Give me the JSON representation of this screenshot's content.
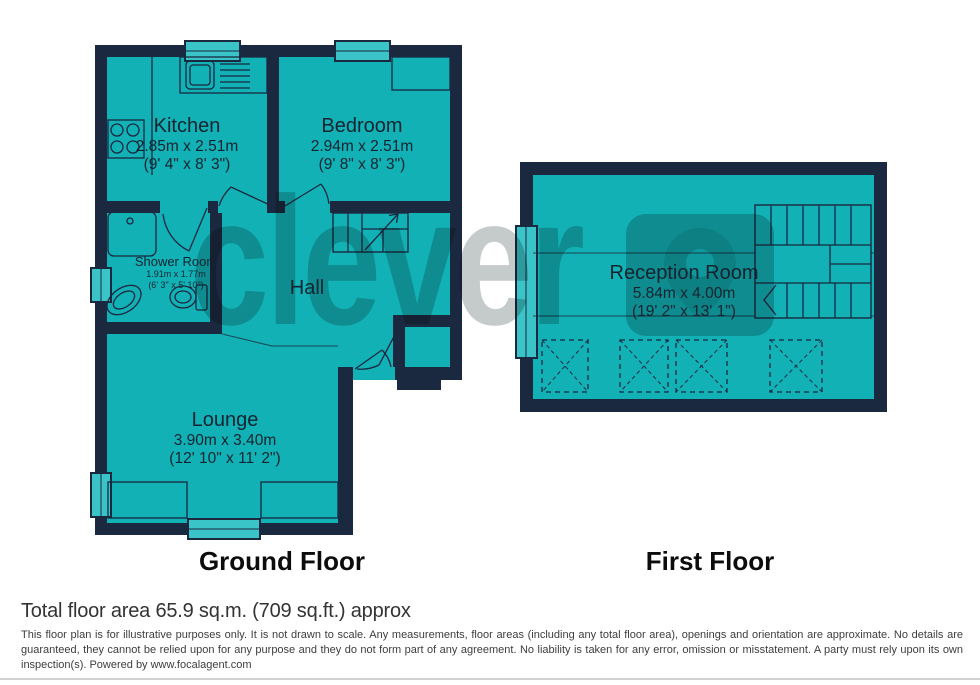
{
  "watermark": {
    "text": "clever"
  },
  "ground_floor": {
    "label": "Ground Floor",
    "rooms": [
      {
        "name": "Kitchen",
        "metric": "2.85m x 2.51m",
        "imperial": "(9' 4\" x 8' 3\")"
      },
      {
        "name": "Bedroom",
        "metric": "2.94m x 2.51m",
        "imperial": "(9' 8\" x 8' 3\")"
      },
      {
        "name": "Shower Room",
        "metric": "1.91m x 1.77m",
        "imperial": "(6' 3\" x 5' 10\")"
      },
      {
        "name": "Hall"
      },
      {
        "name": "Lounge",
        "metric": "3.90m x 3.40m",
        "imperial": "(12' 10\" x 11' 2\")"
      }
    ]
  },
  "first_floor": {
    "label": "First Floor",
    "rooms": [
      {
        "name": "Reception Room",
        "metric": "5.84m x 4.00m",
        "imperial": "(19' 2\" x 13' 1\")"
      }
    ]
  },
  "footer": {
    "total_area": "Total floor area 65.9 sq.m. (709 sq.ft.) approx",
    "disclaimer": "This floor plan is for illustrative purposes only. It is not drawn to scale. Any measurements, floor areas (including any total floor area), openings and orientation are approximate. No details are guaranteed, they cannot be relied upon for any purpose and they do not form part of any agreement. No liability is taken for any error, omission or misstatement. A party must rely upon its own inspection(s). Powered by www.focalagent.com"
  },
  "colors": {
    "teal": "#12b1b5",
    "wall": "#1a2840",
    "window": "#3ac4c8",
    "watermark": "#c5caca"
  }
}
